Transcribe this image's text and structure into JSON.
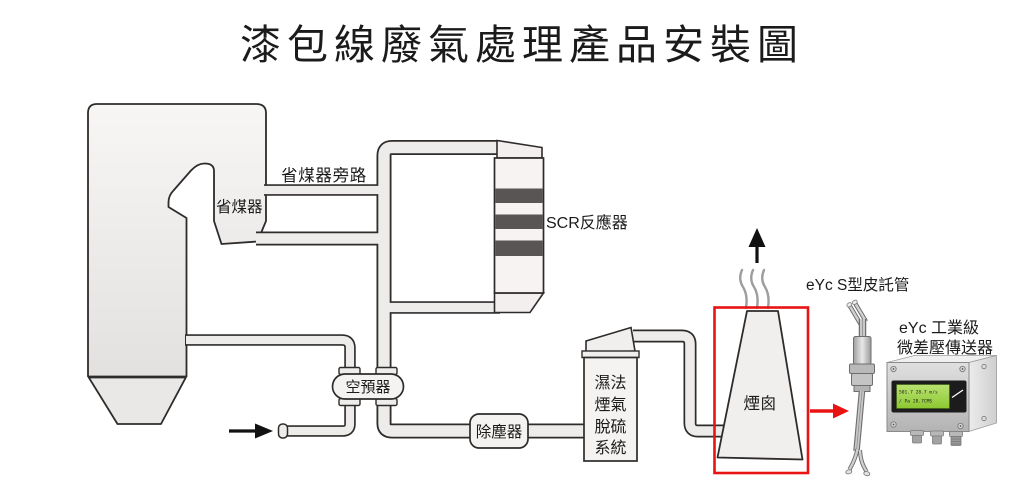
{
  "title": "漆包線廢氣處理產品安裝圖",
  "colors": {
    "outline": "#2e2c2b",
    "pipe_fill": "#edecea",
    "equipment_fill": "#f4f2f1",
    "scr_band": "#5a5555",
    "highlight_red": "#e81313",
    "smoke_gray": "#9d9d9d",
    "lcd_green": "#a5d94a"
  },
  "labels": {
    "economizer_bypass": "省煤器旁路",
    "economizer": "省煤器",
    "scr": "SCR反應器",
    "air_preheater": "空預器",
    "dust_collector": "除塵器",
    "fgd": [
      "濕法",
      "煙氣",
      "脫硫",
      "系統"
    ],
    "chimney": "煙囪",
    "pitot": "eYc S型皮託管",
    "transmitter": [
      "eYc 工業級",
      "微差壓傳送器"
    ]
  },
  "lcd": {
    "line1": "501.7 28.7 m/s",
    "line2": "/ Pa   28.7CMS",
    "logo": "eYc"
  },
  "icons": {
    "exhaust": "up-arrow-icon",
    "air_inlet": "right-arrow-icon",
    "measurement_link": "red-right-arrow-icon"
  }
}
